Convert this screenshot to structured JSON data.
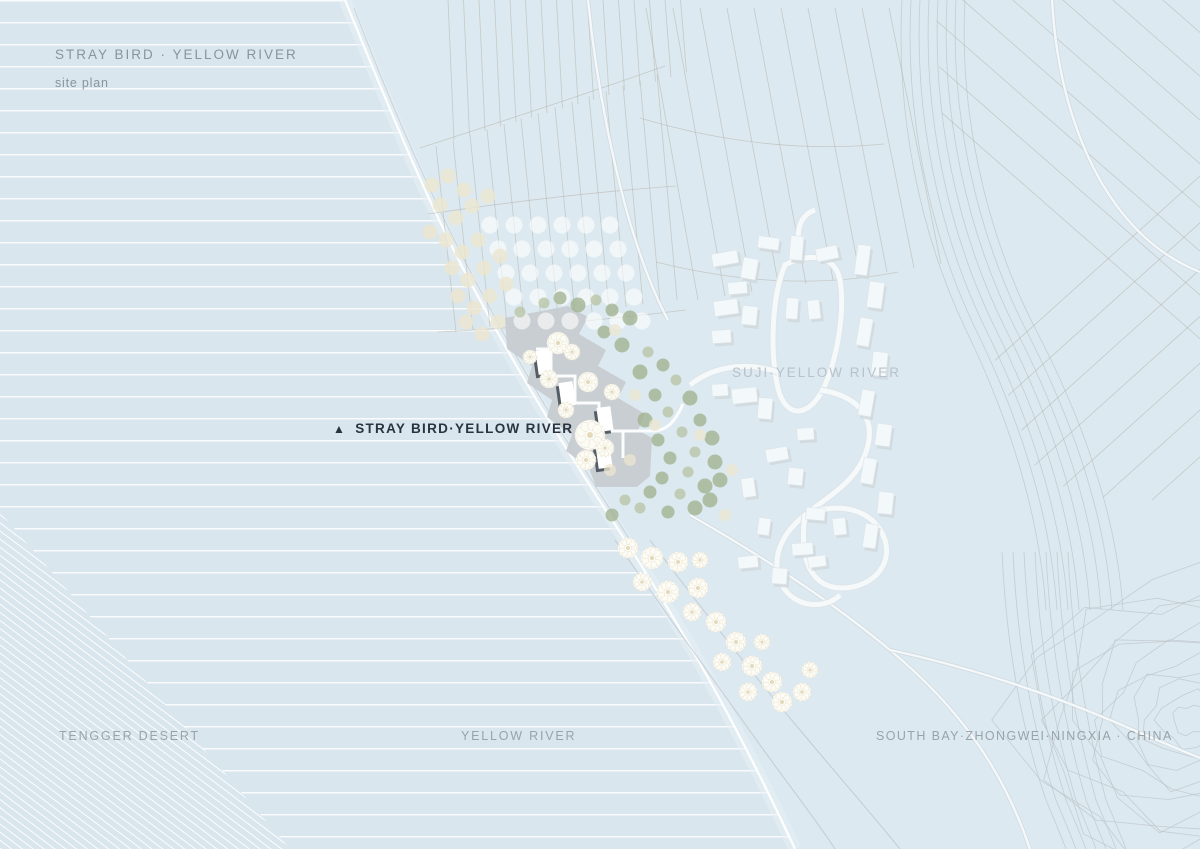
{
  "title_block": {
    "title": "STRAY BIRD · YELLOW RIVER",
    "subtitle": "site plan"
  },
  "labels": {
    "site_marker": "STRAY BIRD·YELLOW RIVER",
    "site_marker_icon": "▲",
    "village": "SUJI·YELLOW RIVER",
    "desert": "TENGGER DESERT",
    "river": "YELLOW RIVER",
    "region": "SOUTH BAY·ZHONGWEI·NINGXIA · CHINA"
  },
  "colors": {
    "water_bg": "#d9e6ee",
    "land": "#dce9f0",
    "site_gray": "#c8ccd1",
    "building_white": "#ffffff",
    "building_shadow": "#4a525b",
    "village_white": "#f3f8fa",
    "village_shadow": "#cfd7db",
    "tree_green": "#a2b28e",
    "tree_cream": "#ece6d0",
    "contour_gray": "#bcc3c8",
    "grid_brown": "#b5aea6",
    "road_white": "#f7fafb",
    "title_gray": "#8b939b",
    "label_gray": "#99a3aa",
    "label_faint": "#b7c2cb",
    "marker_navy": "#2a3440"
  }
}
